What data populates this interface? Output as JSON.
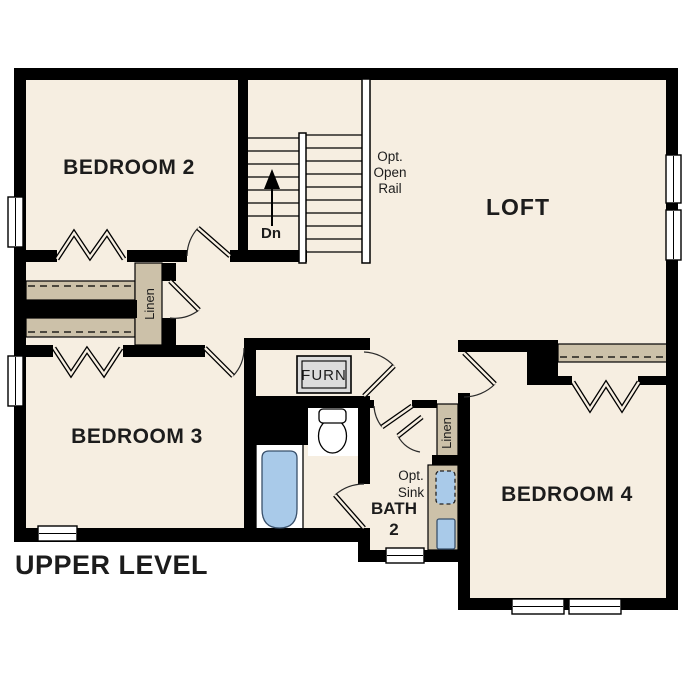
{
  "plan_title": "UPPER LEVEL",
  "rooms": {
    "bedroom2": "BEDROOM 2",
    "bedroom3": "BEDROOM 3",
    "bedroom4": "BEDROOM 4",
    "loft": "LOFT",
    "bath2_line1": "BATH",
    "bath2_line2": "2"
  },
  "labels": {
    "furnace": "FURN",
    "linen_left": "Linen",
    "linen_right": "Linen",
    "stairs_down": "Dn",
    "opt_open_rail_line1": "Opt.",
    "opt_open_rail_line2": "Open",
    "opt_open_rail_line3": "Rail",
    "opt_sink_line1": "Opt.",
    "opt_sink_line2": "Sink"
  },
  "colors": {
    "wall": "#000000",
    "floor": "#f6eee1",
    "casework_tan": "#ccc1a9",
    "fixture_blue": "#a9cae9",
    "furnace_gray": "#dcdcdc",
    "text": "#1c1c1c",
    "background": "#ffffff"
  }
}
